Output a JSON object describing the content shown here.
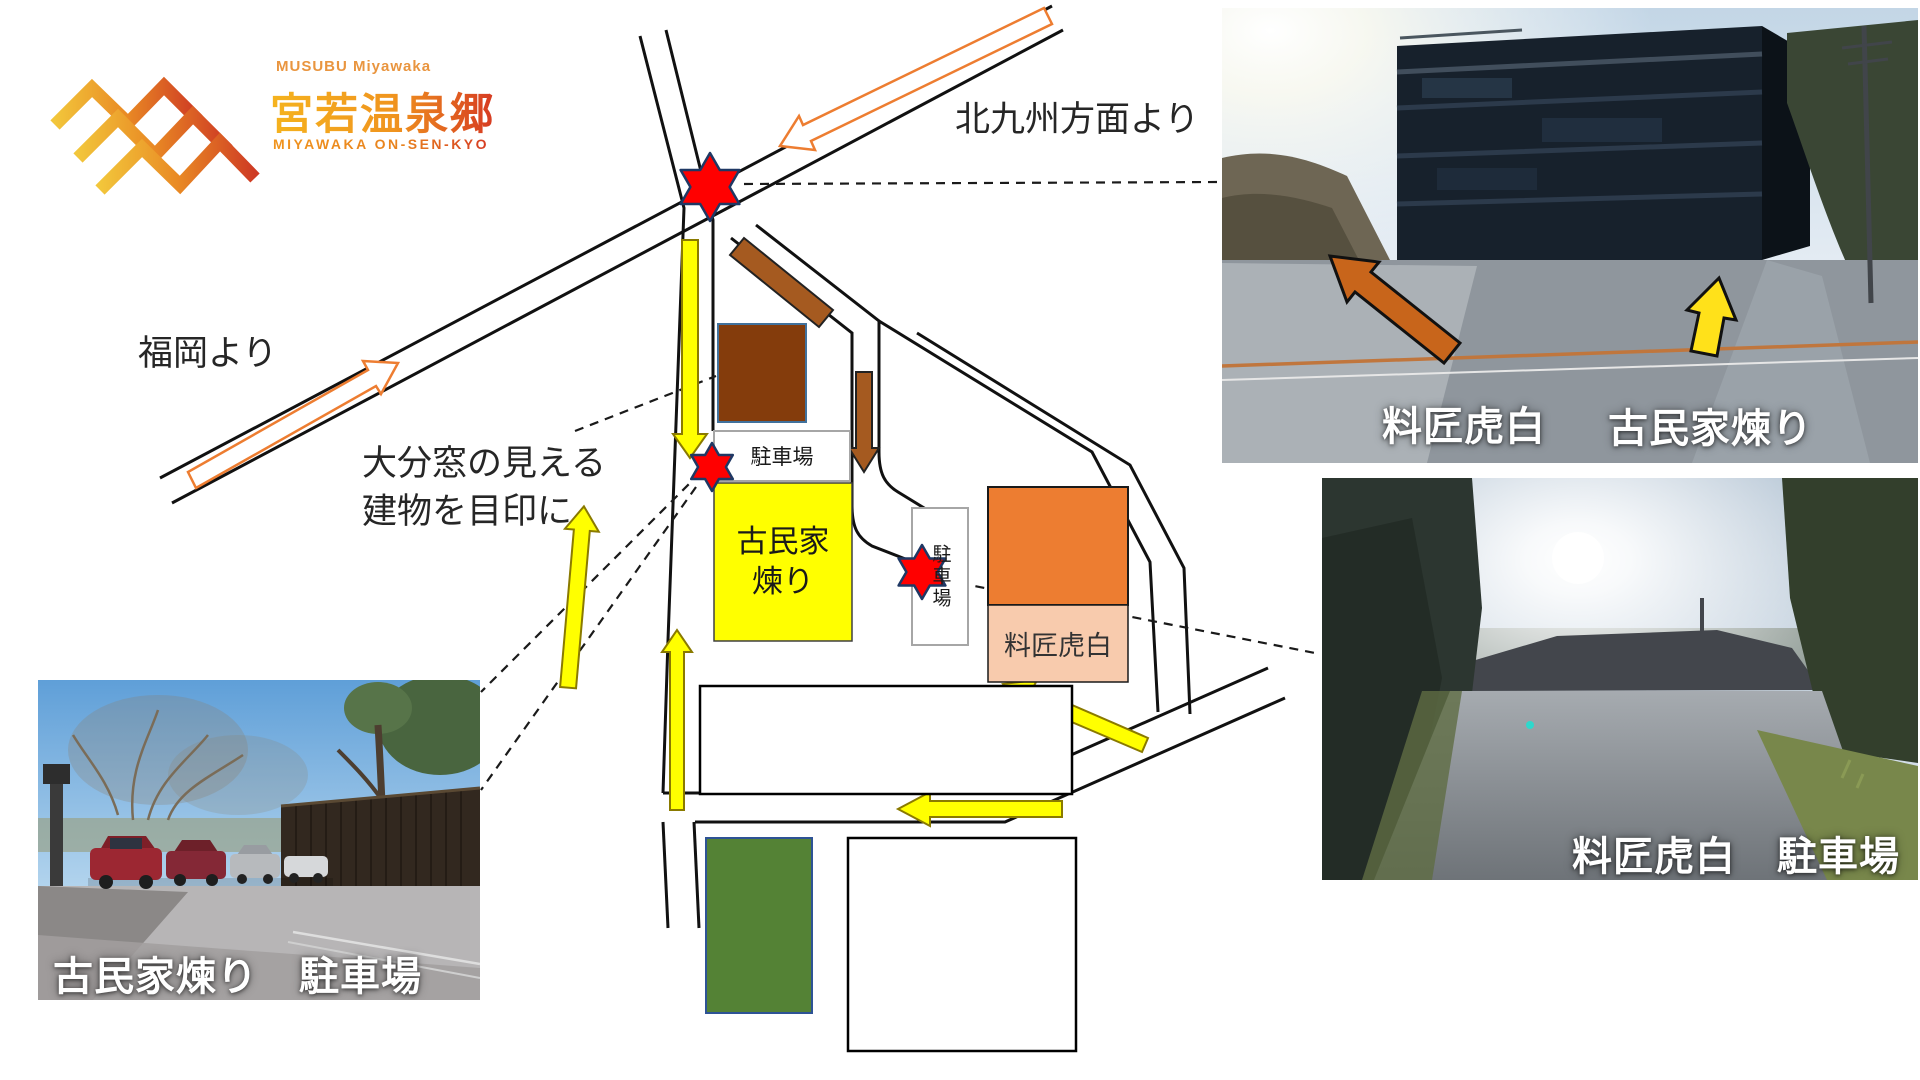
{
  "logo": {
    "tagline": "MUSUBU Miyawaka",
    "title": "宮若温泉郷",
    "subtitle": "MIYAWAKA ON-SEN-KYO"
  },
  "map": {
    "from_kitakyushu": "北九州方面より",
    "from_fukuoka": "福岡より",
    "landmark_note_line1": "大分窓の見える",
    "landmark_note_line2": "建物を目印に",
    "parking_label": "駐車場",
    "parking_label_vertical": "駐車場",
    "kominka_neri_line1": "古民家",
    "kominka_neri_line2": "煉り",
    "kohaku_label": "料匠虎白"
  },
  "photos": {
    "building": {
      "label_kohaku": "料匠虎白",
      "label_kominka": "古民家煉り"
    },
    "kohaku_parking": {
      "label": "料匠虎白　駐車場"
    },
    "neri_parking": {
      "label": "古民家煉り　駐車場"
    }
  },
  "colors": {
    "star_red": "#FF0000",
    "route_yellow": "#FFFF00",
    "route_brown": "#A55A20",
    "highway_orange": "#ED7D31",
    "building_brown": "#843C0C",
    "kominka_yellow": "#FFFF00",
    "kohaku_orange": "#ED7D31",
    "kohaku_pink": "#F8CBAD",
    "field_green": "#548235",
    "photo_arrow_orange": "#C8651B",
    "photo_arrow_yellow": "#FFE11A",
    "logo_orange": "#F0941E",
    "logo_red": "#D63A22"
  }
}
